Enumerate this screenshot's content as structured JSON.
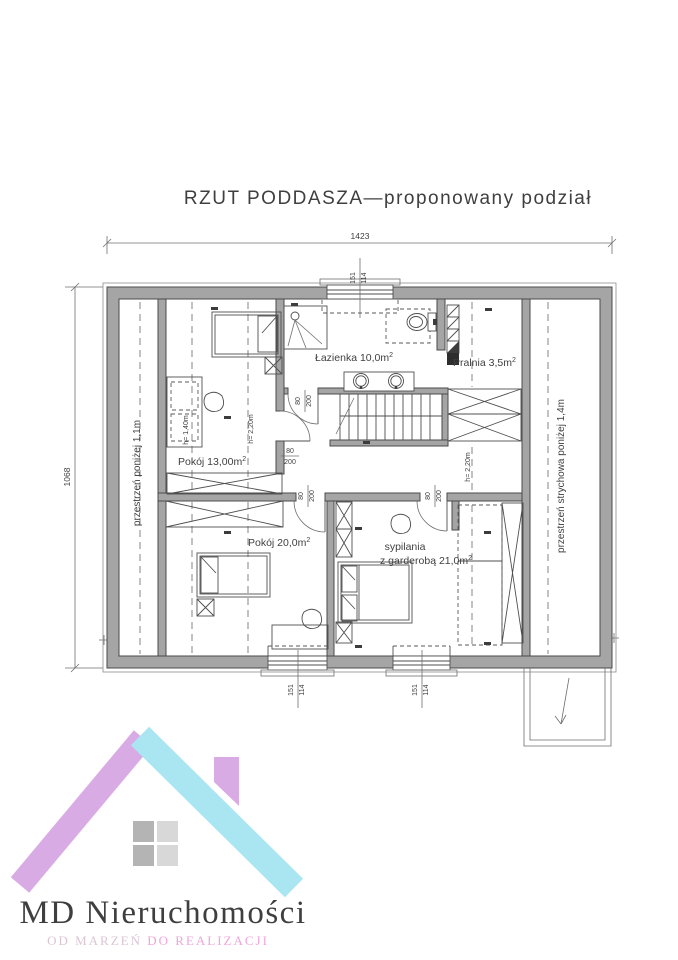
{
  "title": "RZUT PODDASZA—proponowany podział",
  "dims": {
    "width": "1423",
    "height": "1068",
    "win_num": "151",
    "win_den": "114",
    "door_num": "80",
    "door_den": "200"
  },
  "rooms": {
    "bathroom": "Łazienka 10,0m",
    "laundry": "Pralnia 3,5m",
    "room13": "Pokój 13,00m",
    "room20": "Pokój 20,0m",
    "bedroom_line1": "sypilania",
    "bedroom_line2": "z garderobą 21,0m",
    "sup": "2",
    "left_strip": "przestrzeń poniżej 1,1m",
    "right_strip": "przestrzeń strychowa poniżej 1,4m",
    "h140": "h= 1,40m",
    "h220": "h= 2,20m"
  },
  "logo": {
    "name": "MD Nieruchomości",
    "tagline1": "OD MARZEŃ",
    "tagline2": "DO REALIZACJI"
  },
  "colors": {
    "wall": "#a5a5a5",
    "line": "#4a4a4a",
    "logo_cyan": "#a9e6f1",
    "logo_purple": "#d9abe4",
    "logo_pink": "#f0a6d8",
    "logo_mauve": "#d9c6d5",
    "pane_dark": "#b4b4b4",
    "pane_light": "#d8d8d8"
  }
}
